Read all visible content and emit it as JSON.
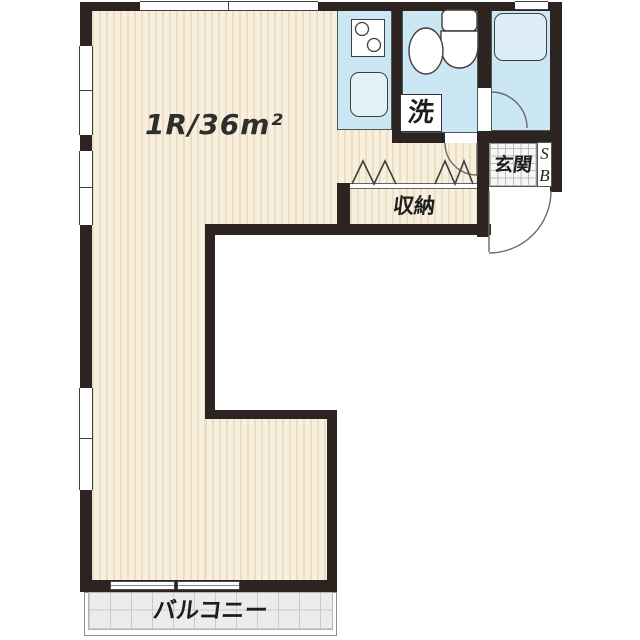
{
  "plan": {
    "room_label": "1R/36m²",
    "labels": {
      "laundry": "洗",
      "entrance": "玄関",
      "shoe_box_top": "S",
      "shoe_box_bottom": "B",
      "closet": "収納",
      "balcony": "バルコニー"
    },
    "colors": {
      "wall": "#2d2421",
      "floor": "#f8efdd",
      "floor_stripe": "#eadec6",
      "wet_area": "#cbe7f3",
      "bathtub": "#ddeef8",
      "fixture": "#ffffff",
      "balcony_fill": "#ececec",
      "balcony_grid": "#c9c9c9",
      "text": "#1d1d1d"
    }
  }
}
